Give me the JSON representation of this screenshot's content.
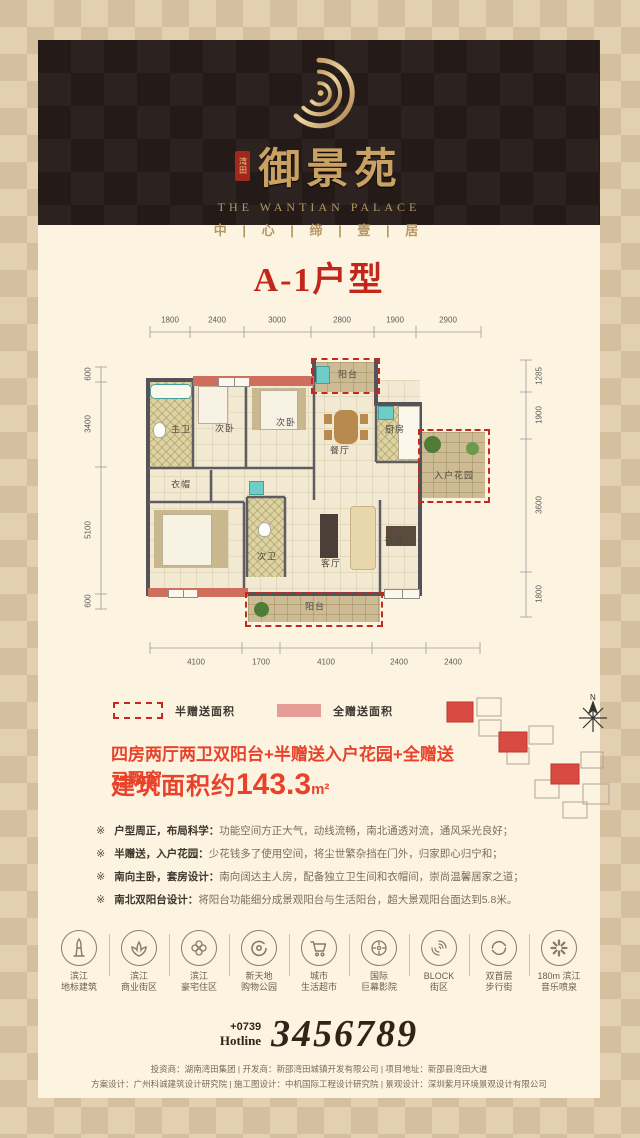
{
  "colors": {
    "accent_red": "#e8432a",
    "title_red": "#c3271b",
    "gold": "#c9a263",
    "legend_pink": "#e79d95",
    "wall_red": "#cf6e5c"
  },
  "header": {
    "seal_chars": "湾田",
    "brand_cn": "御景苑",
    "brand_en": "THE WANTIAN PALACE",
    "slogan": "中 | 心 | 缔 | 壹 | 居"
  },
  "unit_title": "A-1户型",
  "floorplan": {
    "dims_top": [
      "1800",
      "2400",
      "3000",
      "2800",
      "1900",
      "2900"
    ],
    "dims_bottom": [
      "4100",
      "1700",
      "4100",
      "2400",
      "2400"
    ],
    "dims_left": [
      "600",
      "3400",
      "5100",
      "600"
    ],
    "dims_right": [
      "1285",
      "1900",
      "3600",
      "1800"
    ],
    "rooms": [
      {
        "label": "主卫"
      },
      {
        "label": "次卧"
      },
      {
        "label": "次卧"
      },
      {
        "label": "阳台"
      },
      {
        "label": "餐厅"
      },
      {
        "label": "厨房"
      },
      {
        "label": "入户花园"
      },
      {
        "label": "衣帽"
      },
      {
        "label": "次卫"
      },
      {
        "label": "客厅"
      },
      {
        "label": "书房"
      },
      {
        "label": "阳台"
      }
    ],
    "compass": "N"
  },
  "legend": {
    "half_label": "半赠送面积",
    "full_label": "全赠送面积"
  },
  "summary": {
    "headline": "四房两厅两卫双阳台+半赠送入户花园+全赠送三飘窗",
    "area_prefix": "建筑面积约",
    "area_value": "143.3",
    "area_unit": "m²"
  },
  "features": [
    {
      "marker": "※",
      "lead": "户型周正，布局科学：",
      "text": "功能空间方正大气，动线流畅，南北通透对流，通风采光良好；"
    },
    {
      "marker": "※",
      "lead": "半赠送，入户花园：",
      "text": "少花钱多了使用空间，将尘世繁杂挡在门外，归家即心归宁和；"
    },
    {
      "marker": "※",
      "lead": "南向主卧，套房设计：",
      "text": "南向阔达主人房，配备独立卫生间和衣帽间，崇尚温馨居家之道；"
    },
    {
      "marker": "※",
      "lead": "南北双阳台设计：",
      "text": "将阳台功能细分成景观阳台与生活阳台，超大景观阳台面达到5.8米。"
    }
  ],
  "amenities": [
    {
      "line1": "滨江",
      "line2": "地标建筑"
    },
    {
      "line1": "滨江",
      "line2": "商业街区"
    },
    {
      "line1": "滨江",
      "line2": "豪宅住区"
    },
    {
      "line1": "新天地",
      "line2": "购物公园"
    },
    {
      "line1": "城市",
      "line2": "生活超市"
    },
    {
      "line1": "国际",
      "line2": "巨幕影院"
    },
    {
      "line1": "BLOCK",
      "line2": "街区"
    },
    {
      "line1": "双首层",
      "line2": "步行街"
    },
    {
      "line1": "180m 滨江",
      "line2": "音乐喷泉"
    }
  ],
  "hotline": {
    "prefix": "+0739",
    "label": "Hotline",
    "number": "3456789"
  },
  "footer": {
    "line1": "投资商：湖南湾田集团 | 开发商：新邵湾田城镇开发有限公司 | 项目地址：新邵县湾田大道",
    "line2": "方案设计：广州科诚建筑设计研究院 | 施工图设计：中机国际工程设计研究院 | 景观设计：深圳紫月环境景观设计有限公司"
  }
}
